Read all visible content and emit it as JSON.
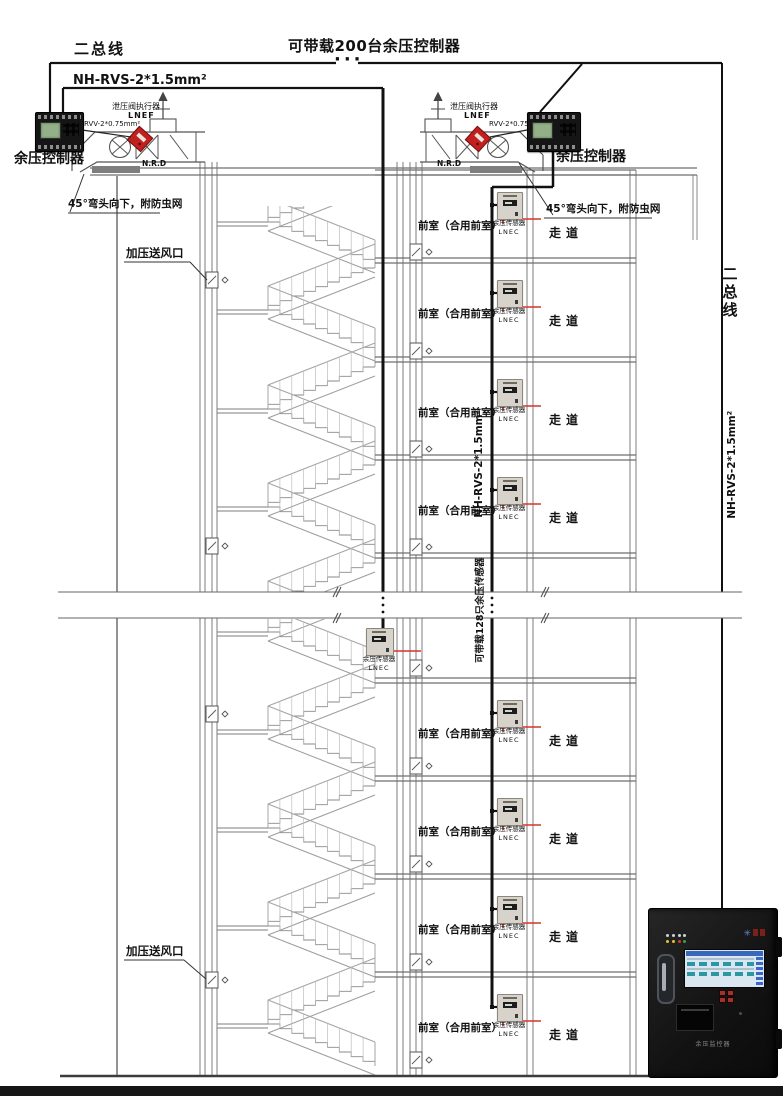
{
  "header": {
    "title": "可带载200台余压控制器",
    "ellipsis": "···"
  },
  "bus_left": {
    "name": "二总线",
    "wire": "NH-RVS-2*1.5mm²"
  },
  "bus_right": {
    "name": "二总线",
    "wire": "NH-RVS-2*1.5mm²"
  },
  "riser": {
    "wire": "NH-RVS-2*1.5mm²",
    "capacity_note": "可带载128只余压传感器"
  },
  "controller": {
    "label": "余压控制器"
  },
  "actuator": {
    "name": "泄压阀执行器",
    "model": "LNEF",
    "wire": "RVV-2*0.75mm²"
  },
  "duct": {
    "damper": "N.R.D",
    "elbow_note": "45°弯头向下，附防虫网",
    "supply_outlet": "加压送风口"
  },
  "sensor": {
    "name": "余压传感器",
    "model": "LNEC",
    "count": 9
  },
  "rooms": {
    "front_room": "前室（合用前室）",
    "corridor": "走道",
    "floor_count": 8
  },
  "monitor": {
    "label": "余压监控器"
  },
  "colors": {
    "wire_red": "#d9342b",
    "bus_black": "#111111",
    "actuator_red": "#c21f1f",
    "line_gray": "#7c7c7c"
  }
}
